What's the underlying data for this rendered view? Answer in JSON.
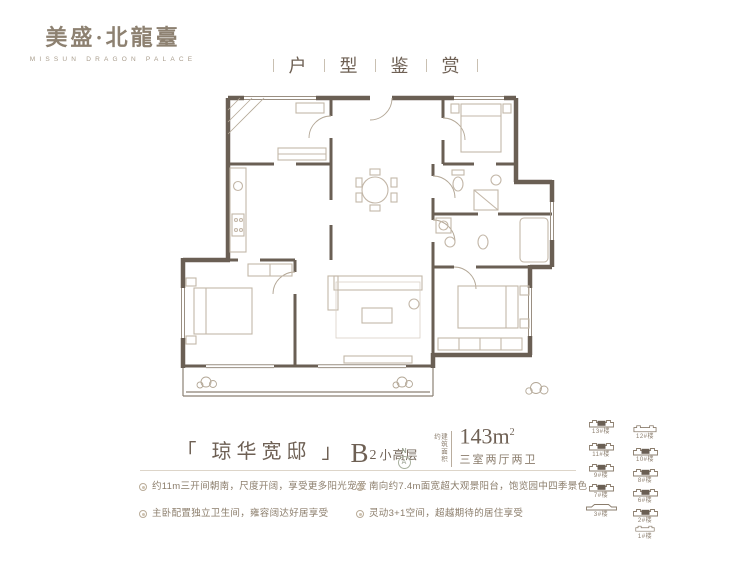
{
  "brand": {
    "name_cn": "美盛·北龍臺",
    "name_en": "MISSUN DRAGON PALACE"
  },
  "header": {
    "chars": [
      "户",
      "型",
      "鉴",
      "赏"
    ]
  },
  "unit": {
    "name": "「 琼华宽邸 」",
    "model": "B",
    "model_sub": "2",
    "model_suffix": "小高层",
    "area_label": "建筑面积约",
    "area_value": "143m",
    "area_sup": "2",
    "rooms": "三室两厅两卫"
  },
  "compass": {
    "n": "N",
    "a": "A"
  },
  "features": [
    "约11m三开间朝南，尺度开阔，享受更多阳光宠爱",
    "主卧配置独立卫生间，雍容阔达好居享受",
    "南向约7.4m面宽超大观景阳台，饱览园中四季景色",
    "灵动3+1空间，超越期待的居住享受"
  ],
  "siteplan": {
    "items": [
      {
        "label": "13#楼",
        "filled": true
      },
      {
        "label": "11#楼",
        "filled": true
      },
      {
        "label": "9#楼",
        "filled": true
      },
      {
        "label": "7#楼",
        "filled": true
      },
      {
        "label": "3#楼",
        "filled": false
      },
      {
        "label": "12#楼",
        "filled": false
      },
      {
        "label": "10#楼",
        "filled": true
      },
      {
        "label": "8#楼",
        "filled": true
      },
      {
        "label": "6#楼",
        "filled": true
      },
      {
        "label": "2#楼",
        "filled": true
      },
      {
        "label": "1#楼",
        "filled": false
      }
    ]
  },
  "colors": {
    "wall": "#6a5f54",
    "brand": "#8d8171",
    "text": "#8a7c6c",
    "divider": "#ddd5c9"
  }
}
